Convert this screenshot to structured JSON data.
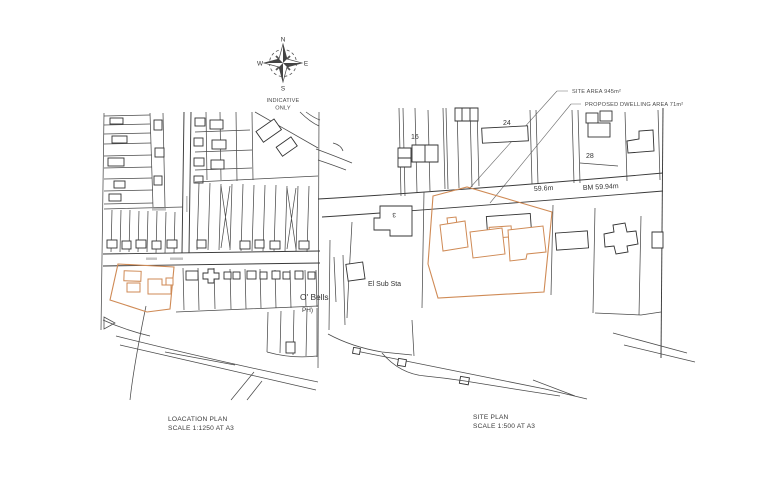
{
  "sheet": {
    "background": "#ffffff",
    "ink_color": "#3f3f3f",
    "site_boundary_color": "#cf8a55"
  },
  "compass": {
    "north": "N",
    "east": "E",
    "south": "S",
    "west": "W",
    "note_line1": "INDICATIVE",
    "note_line2": "ONLY"
  },
  "annotations": {
    "site_area": "SITE AREA 945m²",
    "proposed_dwelling_area": "PROPOSED DWELLING AREA 71m²"
  },
  "location_plan": {
    "title": "LOACATION PLAN",
    "scale": "SCALE 1:1250 AT A3"
  },
  "site_plan": {
    "title": "SITE PLAN",
    "scale": "SCALE 1:500 AT A3",
    "labels": {
      "house_16": "16",
      "house_24": "24",
      "house_28": "28",
      "house_3": "3",
      "spot_height": "59.6m",
      "bench_mark": "BM 59.94m",
      "substation": "El Sub Sta",
      "pub_name": "O' Bells",
      "pub_type": "PH)"
    }
  }
}
